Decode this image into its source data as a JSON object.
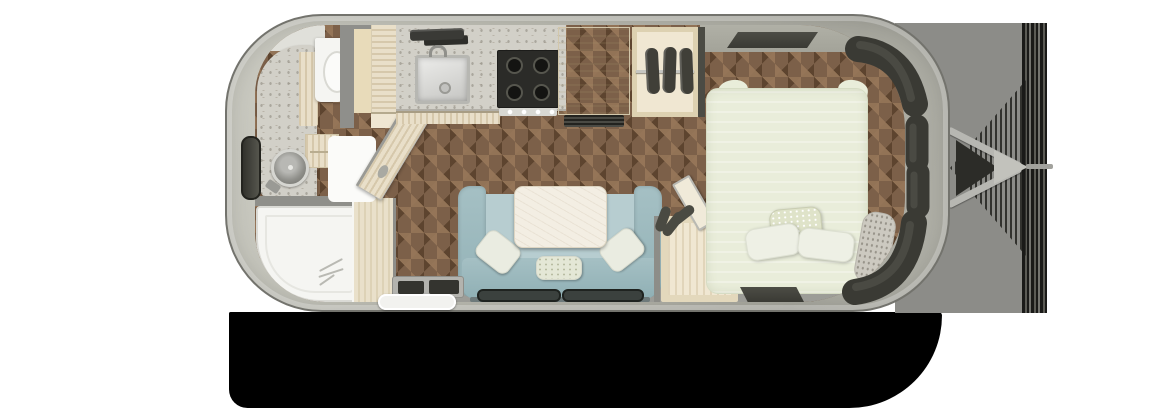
{
  "title": "Travel trailer floor plan (top-down)",
  "colors": {
    "shell": "#b9b9af",
    "shell_edge": "#73736d",
    "interior_gray": "#9c9c97",
    "wood_floor": "#7c6049",
    "wood_floor_dark": "#654c35",
    "wood_floor_light": "#8f7258",
    "marble": "#d2d0c8",
    "cabinet_wood": "#e9dfc9",
    "white_fixture": "#f5f5f2",
    "sofa": "#a5c0c4",
    "sofa_seat": "#b7cdd0",
    "pillow": "#eaece1",
    "table": "#f3eee3",
    "bed": "#e9edda",
    "bed_pillow": "#eef0e5",
    "bed_pillow_pattern": "#dfe3c9",
    "window_dark": "#3a3a34",
    "stove": "#2b2b28",
    "hitch_gray": "#8c8c88",
    "hitch_light": "#b7b7b2",
    "shadow": "#000000",
    "step_white": "#f2f2ef",
    "closet_interior": "#f0e7d2",
    "divider_tan": "#e9e0ca"
  },
  "fixtures": {
    "canvas": "Travel trailer floor plan",
    "shell": "Trailer shell",
    "shadow": "Ground shadow",
    "hitch": "Tow hitch and A-frame tongue",
    "bathroom_vanity": "Bathroom vanity with round sink",
    "toilet": "Toilet",
    "shower": "Shower",
    "bathroom_door": "Bathroom door (open)",
    "pantry": "Pantry cabinet",
    "kitchen_counter": "Kitchen counter",
    "kitchen_sink": "Kitchen sink",
    "cooktop": "Gas cooktop",
    "refrigerator": "Refrigerator",
    "wardrobe": "Wardrobe with hanging clothes",
    "sofa": "Sofa with pillows",
    "table": "Table",
    "closet": "Front closet with open door",
    "bed": "Bed with pillows",
    "entry_step": "Entry door step",
    "windows": "Wrap-around front windows",
    "floor": "Herringbone wood floor"
  }
}
